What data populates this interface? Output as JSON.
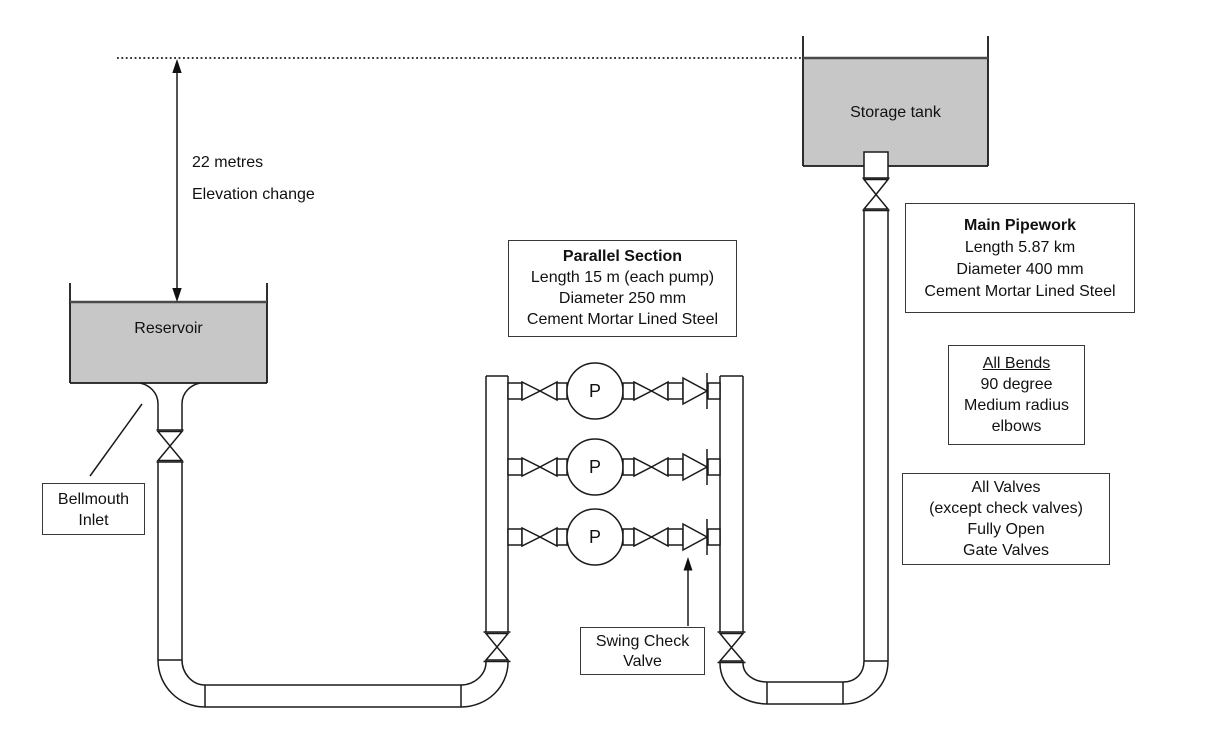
{
  "labels": {
    "elevation_line1": "22 metres",
    "elevation_line2": "Elevation change",
    "reservoir": "Reservoir",
    "storage_tank": "Storage tank",
    "pump": "P"
  },
  "boxes": {
    "bellmouth": {
      "lines": [
        "Bellmouth",
        "Inlet"
      ]
    },
    "parallel_section": {
      "title": "Parallel Section",
      "lines": [
        "Length 15 m (each pump)",
        "Diameter 250 mm",
        "Cement Mortar Lined Steel"
      ]
    },
    "main_pipework": {
      "title": "Main Pipework",
      "lines": [
        "Length 5.87 km",
        "Diameter 400 mm",
        "Cement Mortar Lined Steel"
      ]
    },
    "all_bends": {
      "title": "All Bends",
      "lines": [
        "90 degree",
        "Medium radius",
        "elbows"
      ]
    },
    "all_valves": {
      "lines": [
        "All Valves",
        "(except check valves)",
        "Fully Open",
        "Gate Valves"
      ]
    },
    "swing_check": {
      "lines": [
        "Swing Check",
        "Valve"
      ]
    }
  },
  "colors": {
    "tank_fill": "#c7c7c7",
    "line": "#1a1a1a",
    "surface_line": "#4a4a4a"
  }
}
